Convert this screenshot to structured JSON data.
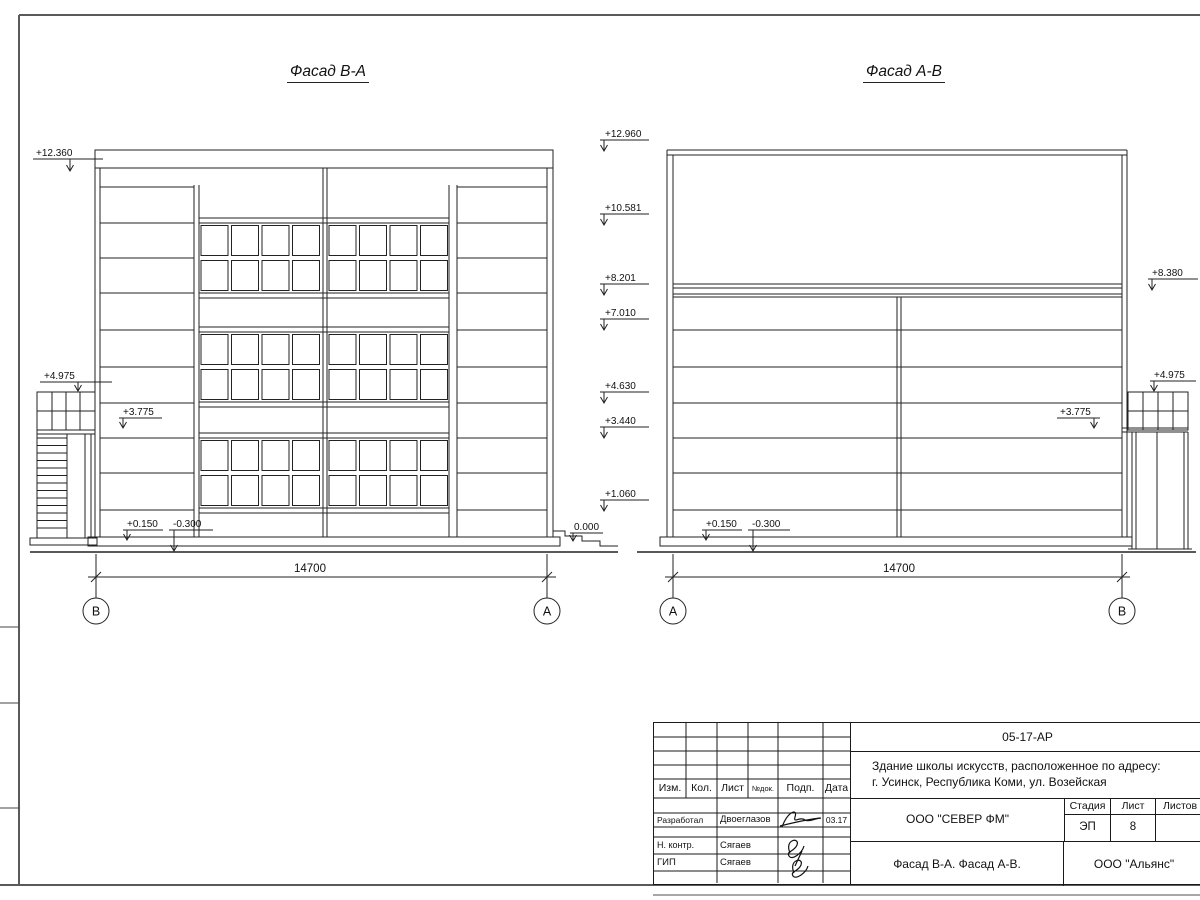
{
  "facades": [
    {
      "title": "Фасад В-А",
      "axis_left": "В",
      "axis_right": "А",
      "dimension": "14700",
      "marks": {
        "top": "+12.360",
        "stair_cap": "+4.975",
        "mid": "+3.775",
        "floor": "+0.150",
        "below_ground": "-0.300",
        "zero": "0.000"
      }
    },
    {
      "title": "Фасад А-В",
      "axis_left": "А",
      "axis_right": "В",
      "dimension": "14700",
      "left_column_marks": [
        "+12.960",
        "+10.581",
        "+8.201",
        "+7.010",
        "+4.630",
        "+3.440",
        "+1.060"
      ],
      "marks": {
        "roof_right": "+8.380",
        "stair_cap": "+4.975",
        "mid": "+3.775",
        "floor": "+0.150",
        "below_ground": "-0.300"
      }
    }
  ],
  "title_block": {
    "doc_number": "05-17-АР",
    "project_line1": "Здание школы искусств, расположенное по адресу:",
    "project_line2": "г. Усинск, Республика Коми, ул. Возейская",
    "col_izm": "Изм.",
    "col_kol": "Кол.",
    "col_list": "Лист",
    "col_ndok": "№док.",
    "col_podp": "Подп.",
    "col_data": "Дата",
    "row_developer_label": "Разработал",
    "row_developer_name": "Двоеглазов",
    "row_developer_date": "03.17",
    "row_ncontr_label": "Н. контр.",
    "row_ncontr_name": "Сягаев",
    "row_gip_label": "ГИП",
    "row_gip_name": "Сягаев",
    "org": "ООО \"СЕВЕР ФМ\"",
    "stage_label": "Стадия",
    "sheet_label": "Лист",
    "sheets_label": "Листов",
    "stage_value": "ЭП",
    "sheet_value": "8",
    "sheets_value": "",
    "drawing_title": "Фасад В-А. Фасад А-В.",
    "contractor": "ООО \"Альянс\""
  }
}
